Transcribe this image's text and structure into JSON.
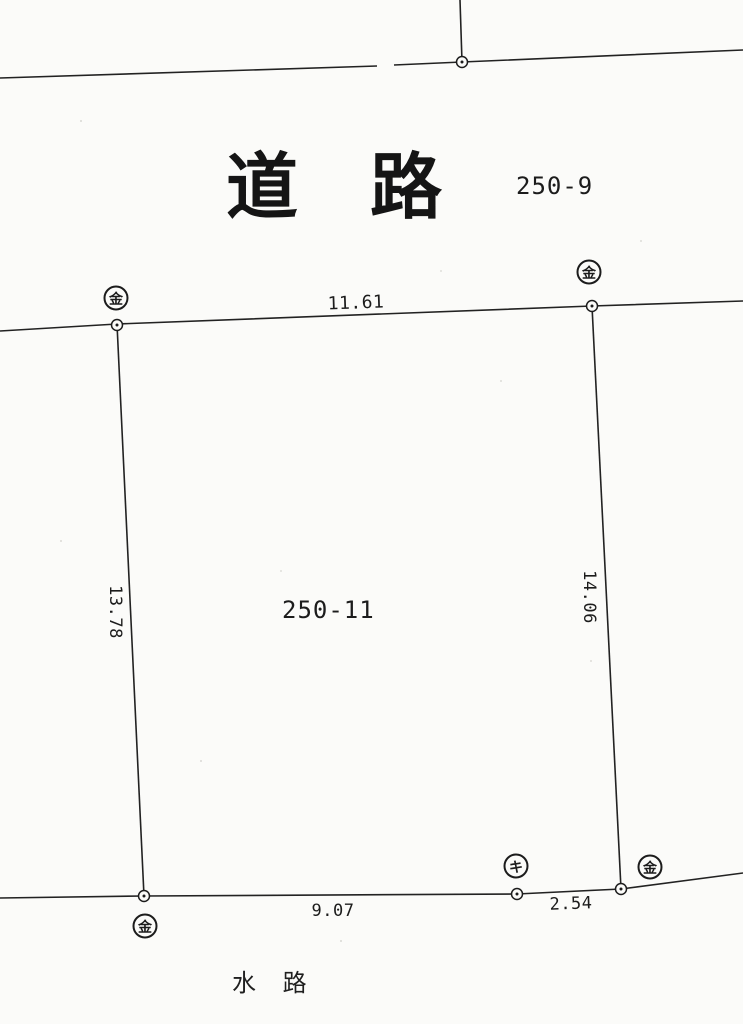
{
  "map": {
    "road_label": "道　路",
    "waterway_label": "水 路",
    "parcels": {
      "road_parcel_number": "250-9",
      "main_parcel_number": "250-11"
    },
    "measurements": {
      "top_edge": "11.61",
      "left_edge": "13.78",
      "right_edge": "14.06",
      "bottom_edge": "9.07",
      "bottom_right_edge": "2.54"
    },
    "markers": {
      "metal_marker_symbol": "金",
      "ki_marker_symbol": "キ"
    },
    "colors": {
      "ink": "#1c1c1c",
      "paper": "#fbfbf9"
    }
  }
}
